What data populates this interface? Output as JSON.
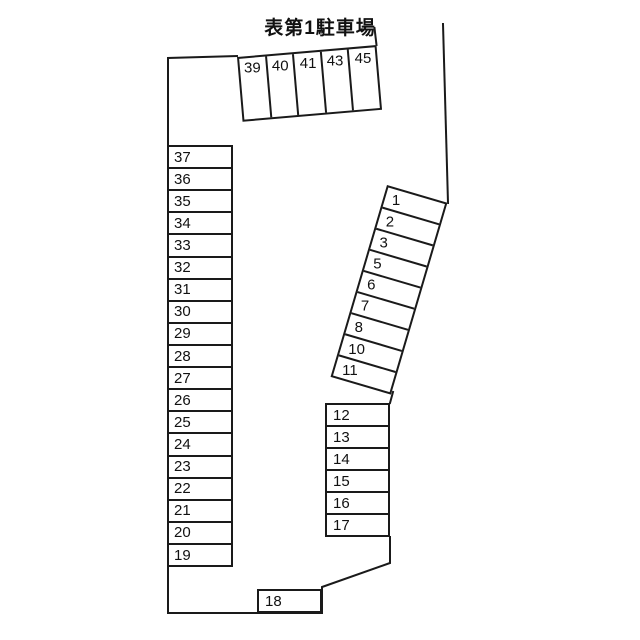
{
  "title": "表第1駐車場",
  "lot": {
    "top_row": {
      "spaces": [
        "39",
        "40",
        "41",
        "43",
        "45"
      ]
    },
    "left_column": {
      "spaces": [
        "37",
        "36",
        "35",
        "34",
        "33",
        "32",
        "31",
        "30",
        "29",
        "28",
        "27",
        "26",
        "25",
        "24",
        "23",
        "22",
        "21",
        "20",
        "19"
      ]
    },
    "diagonal_column": {
      "spaces": [
        "1",
        "2",
        "3",
        "5",
        "6",
        "7",
        "8",
        "10",
        "11"
      ]
    },
    "right_column": {
      "spaces": [
        "12",
        "13",
        "14",
        "15",
        "16",
        "17"
      ]
    },
    "single_space": {
      "label": "18"
    }
  },
  "colors": {
    "background": "#ffffff",
    "line": "#1a1a1a",
    "text": "#111111"
  }
}
